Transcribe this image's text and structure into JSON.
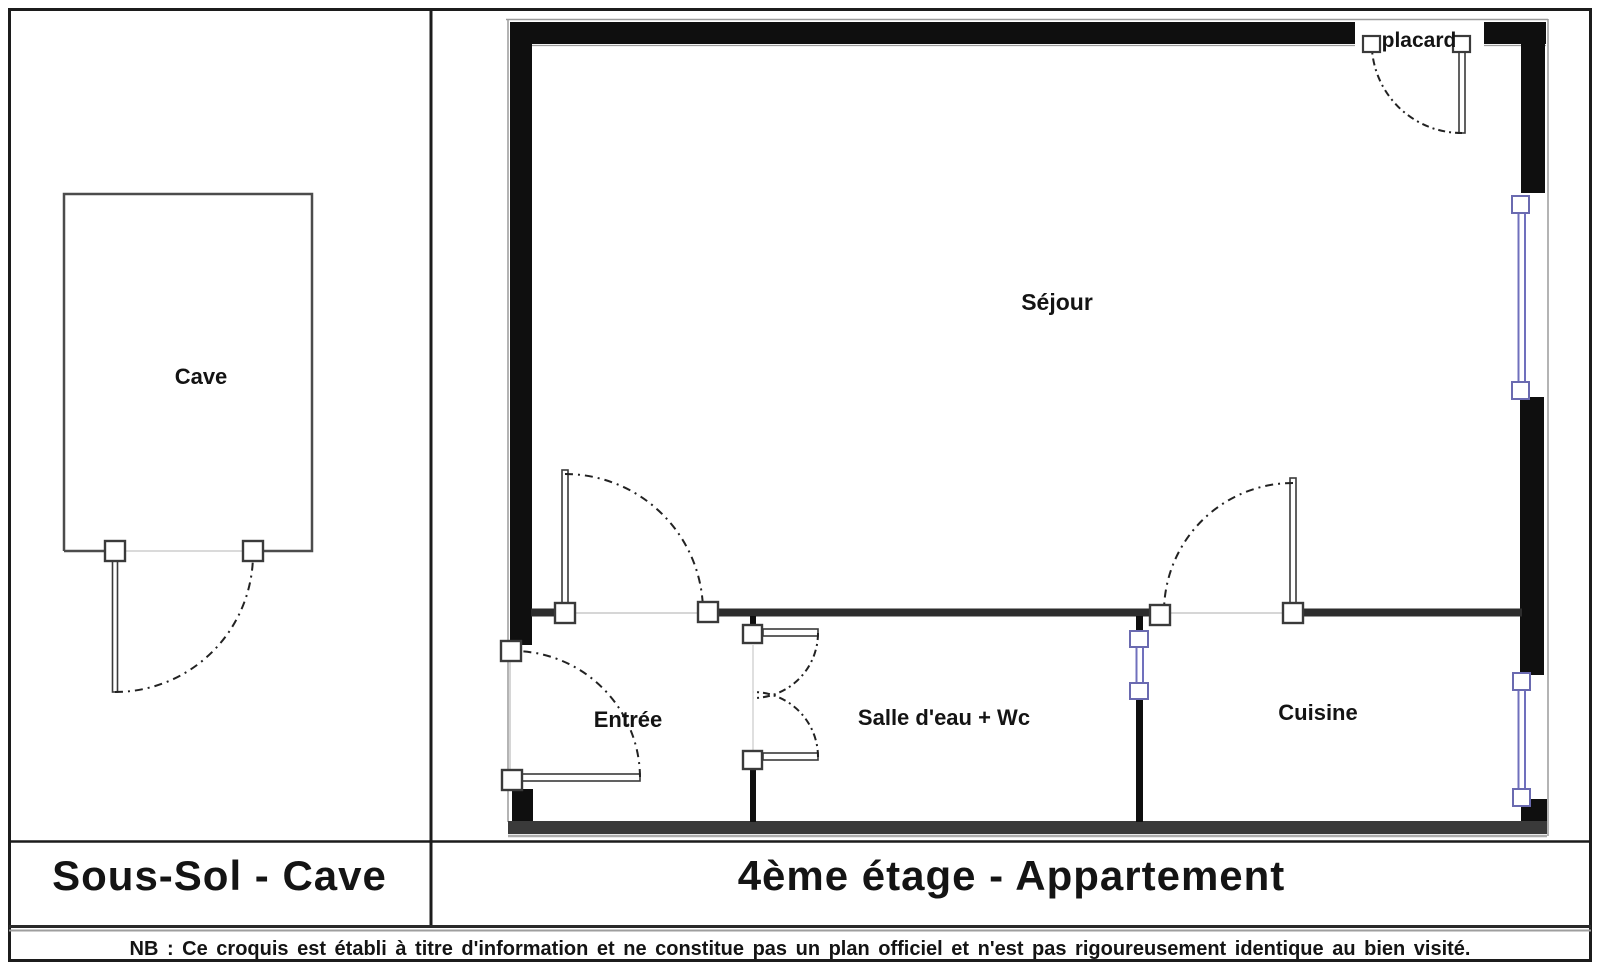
{
  "panels": {
    "left": {
      "title": "Sous-Sol - Cave",
      "room_label": "Cave"
    },
    "right": {
      "title": "4ème étage - Appartement",
      "rooms": {
        "sejour": "Séjour",
        "entree": "Entrée",
        "salle_eau": "Salle d'eau + Wc",
        "cuisine": "Cuisine",
        "placard": "placard"
      }
    }
  },
  "footer": {
    "note": "NB : Ce croquis est établi à titre d'information et ne constitue pas un plan officiel et n'est pas rigoureusement identique au bien visité."
  },
  "colors": {
    "exterior_wall": "#0f0f0f",
    "interior_wall": "#2d2d2d",
    "bottom_wall": "#3a3a3a",
    "window_frame_blue": "#7070bd",
    "door_line": "#3a3a3a",
    "frame_border": "#1c1c1c"
  }
}
